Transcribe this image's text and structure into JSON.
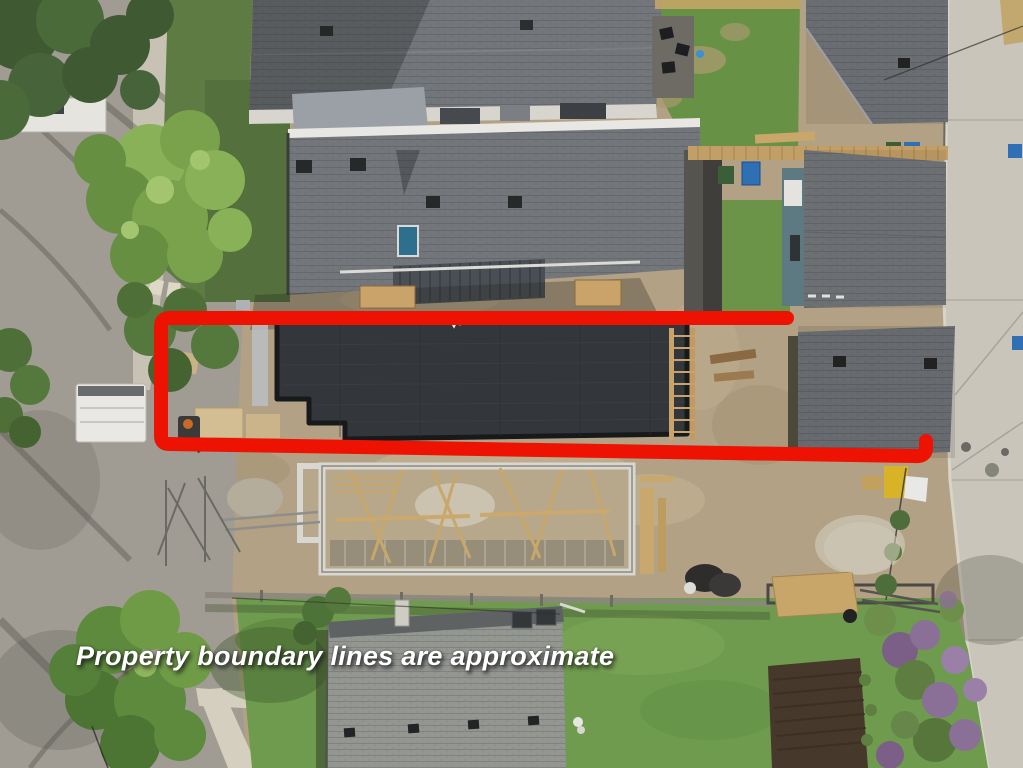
{
  "annotation": {
    "text": "Property boundary lines are approximate"
  },
  "colors": {
    "boundary": "#ee1202",
    "annotation_text": "#ffffff"
  }
}
